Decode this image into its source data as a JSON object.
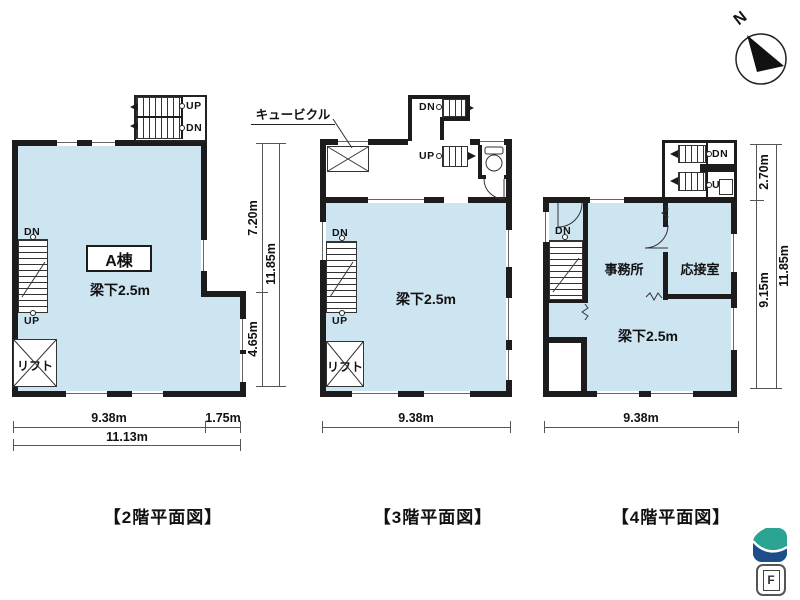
{
  "north_label": "N",
  "colors": {
    "room_fill": "#cde4f1",
    "wall": "#1c1c1c",
    "logo_teal": "#2ba393",
    "logo_blue": "#1d4d8a"
  },
  "plans": [
    {
      "caption": "【2階平面図】",
      "building_label": "A棟",
      "beam_label": "梁下2.5m",
      "lift_label": "リフト",
      "ext_stair": {
        "up": "UP",
        "dn": "DN"
      },
      "int_stair": {
        "dn": "DN",
        "up": "UP"
      },
      "dims": {
        "width_main": "9.38m",
        "width_right": "1.75m",
        "width_total": "11.13m",
        "height_upper": "7.20m",
        "height_lower": "4.65m",
        "height_total": "11.85m"
      }
    },
    {
      "caption": "【3階平面図】",
      "cubicle_label": "キュービクル",
      "beam_label": "梁下2.5m",
      "lift_label": "リフト",
      "ext_stair": {
        "dn": "DN"
      },
      "mid_stair": {
        "up": "UP"
      },
      "int_stair": {
        "dn": "DN",
        "up": "UP"
      },
      "dims": {
        "width_main": "9.38m"
      }
    },
    {
      "caption": "【4階平面図】",
      "office_label": "事務所",
      "reception_label": "応接室",
      "beam_label": "梁下2.5m",
      "ext_stair": {
        "dn": "DN",
        "up": "UP"
      },
      "int_stair": {
        "dn": "DN"
      },
      "dims": {
        "width_main": "9.38m",
        "height_upper": "2.70m",
        "height_lower": "9.15m",
        "height_total": "11.85m"
      }
    }
  ],
  "logos": {
    "f_label": "F"
  }
}
